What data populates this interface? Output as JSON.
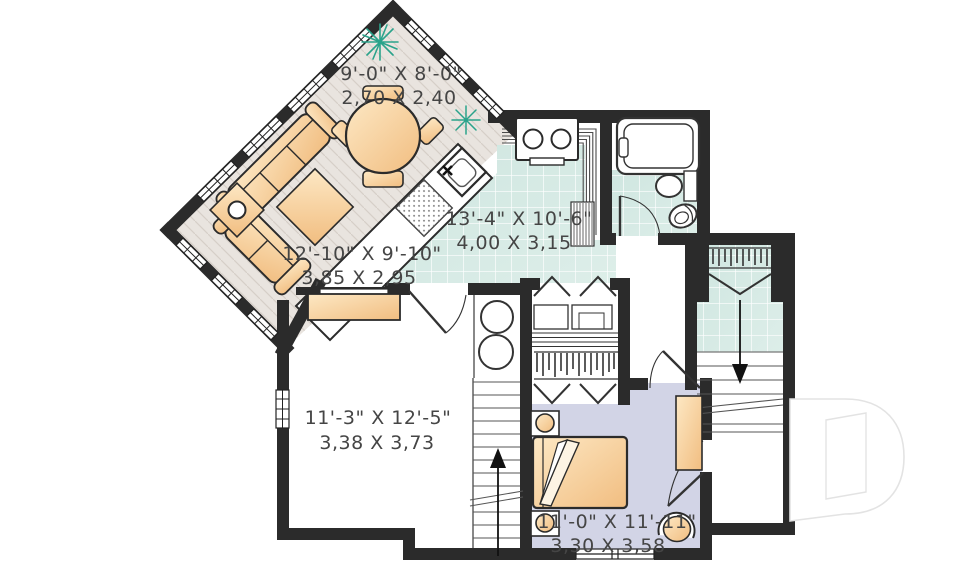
{
  "plan": {
    "type": "floor-plan",
    "level": "basement-apartment",
    "rooms": [
      {
        "name": "dining",
        "imperial": "9'-0\" X 8'-0\"",
        "metric": "2,70 X 2,40"
      },
      {
        "name": "living",
        "imperial": "12'-10\" X 9'-10\"",
        "metric": "3,85 X 2,95"
      },
      {
        "name": "kitchen",
        "imperial": "13'-4\" X 10'-6\"",
        "metric": "4,00 X 3,15"
      },
      {
        "name": "family-room",
        "imperial": "11'-3\" X 12'-5\"",
        "metric": "3,38 X 3,73"
      },
      {
        "name": "bedroom",
        "imperial": "11'-0\" X 11'-11\"",
        "metric": "3,30 X 3,58"
      }
    ],
    "icons": [
      "sofa-icon",
      "armchair-icon",
      "side-table-lamp-icon",
      "ottoman-icon",
      "dining-table-icon",
      "plant-icon",
      "sink-icon",
      "dishwasher-icon",
      "stove-icon",
      "heater-icon",
      "bathtub-icon",
      "bathroom-sink-icon",
      "toilet-icon",
      "closet-hangers-icon",
      "bifold-door-icon",
      "washer-dryer-icon",
      "stairs-up-arrow-icon",
      "stairs-down-arrow-icon",
      "bed-icon",
      "nightstand-lamp-icon",
      "dresser-icon",
      "tub-chair-icon",
      "sideboard-icon",
      "window-icon",
      "door-swing-icon",
      "letter-d-watermark-icon"
    ],
    "colors": {
      "wall": "#2b2b2b",
      "wood_floor": "#e9e4df",
      "wood_hatch": "#d6cfc8",
      "tile_floor": "#d6e9e4",
      "bedroom_floor": "#d2d4e6",
      "furniture_tan_light": "#fde8c4",
      "furniture_tan_dark": "#f1bd80",
      "plant_green": "#2aa38b",
      "label_text": "#454545",
      "watermark_gray": "#e3e3e3"
    }
  }
}
